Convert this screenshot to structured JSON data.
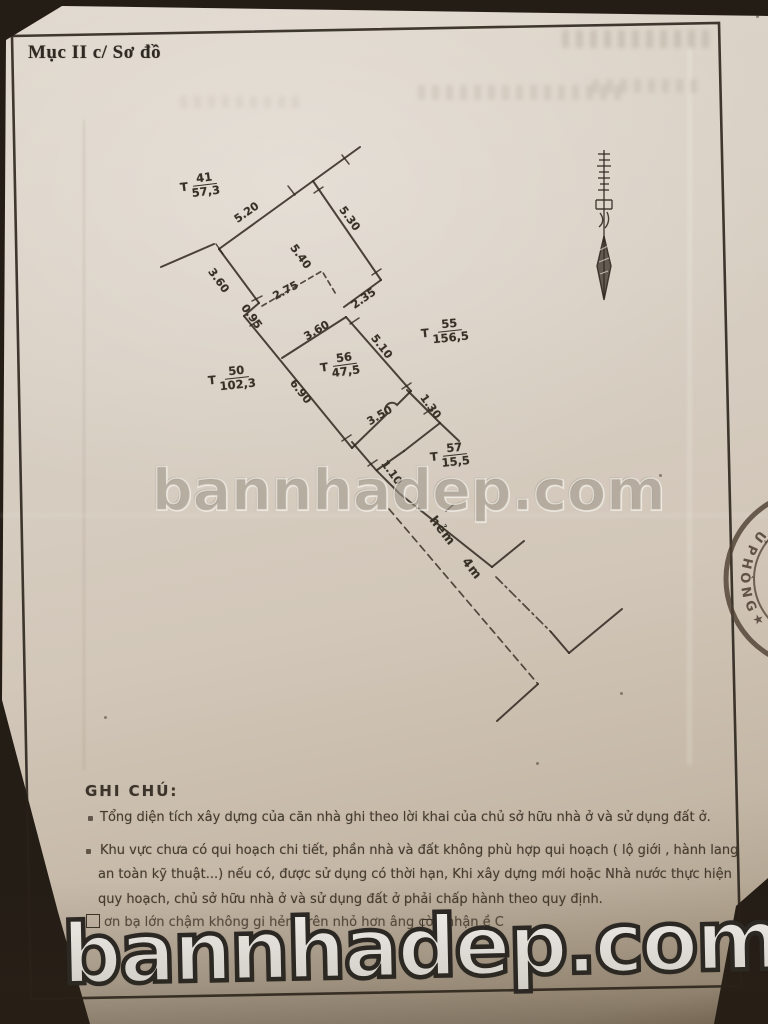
{
  "page": {
    "section_title": "Mục II c/ Sơ đồ"
  },
  "watermark": {
    "text": "bannhadep.com"
  },
  "diagram": {
    "alley_label": "hẻm 4m",
    "measurements": [
      {
        "id": "top-edge",
        "text": "5.20"
      },
      {
        "id": "right-edge-top",
        "text": "5.30"
      },
      {
        "id": "inner-length",
        "text": "5.40"
      },
      {
        "id": "left-edge-top",
        "text": "3.60"
      },
      {
        "id": "dashed-width",
        "text": "2.75"
      },
      {
        "id": "bottom-right-jog",
        "text": "2.35"
      },
      {
        "id": "left-jog",
        "text": "0.95"
      },
      {
        "id": "t56-top-width",
        "text": "3.60"
      },
      {
        "id": "t56-right-edge",
        "text": "5.10"
      },
      {
        "id": "t56-left-edge",
        "text": "6.90"
      },
      {
        "id": "t56-bottom-width",
        "text": "3.50"
      },
      {
        "id": "t57-step",
        "text": "1.30"
      },
      {
        "id": "t57-left-step",
        "text": "1.10"
      }
    ],
    "parcels": [
      {
        "prefix": "T",
        "number": "41",
        "area": "57,3"
      },
      {
        "prefix": "T",
        "number": "55",
        "area": "156,5"
      },
      {
        "prefix": "T",
        "number": "50",
        "area": "102,3"
      },
      {
        "prefix": "T",
        "number": "56",
        "area": "47,5"
      },
      {
        "prefix": "T",
        "number": "57",
        "area": "15,5"
      }
    ]
  },
  "notes": {
    "heading": "GHI CHÚ:",
    "items": [
      {
        "lines": [
          "Tổng diện tích xây dựng của căn nhà ghi theo lời khai của chủ sở hữu nhà ở và sử dụng đất ở."
        ]
      },
      {
        "lines": [
          "Khu vực chưa có qui hoạch chi tiết, phần nhà và đất không phù hợp qui hoạch ( lộ giới , hành lang",
          "an toàn kỹ thuật...) nếu có, được sử dụng có thời hạn, Khi xây dựng mới hoặc Nhà nước thực hiện",
          "quy hoạch, chủ sở hữu nhà ở và sử dụng đất ở phải chấp hành theo quy định."
        ]
      },
      {
        "lines": [
          "ơn bạ lớn chậm không gi        hẻm trên nhỏ hơn        âng còn nhận           ề  C"
        ]
      }
    ]
  },
  "stamp": {
    "text": "PHÒNG",
    "star": "★",
    "extra": "Ủ"
  },
  "colors": {
    "paper": "#d6ccbf",
    "ink": "#332c24",
    "stamp": "#4c3e32"
  }
}
